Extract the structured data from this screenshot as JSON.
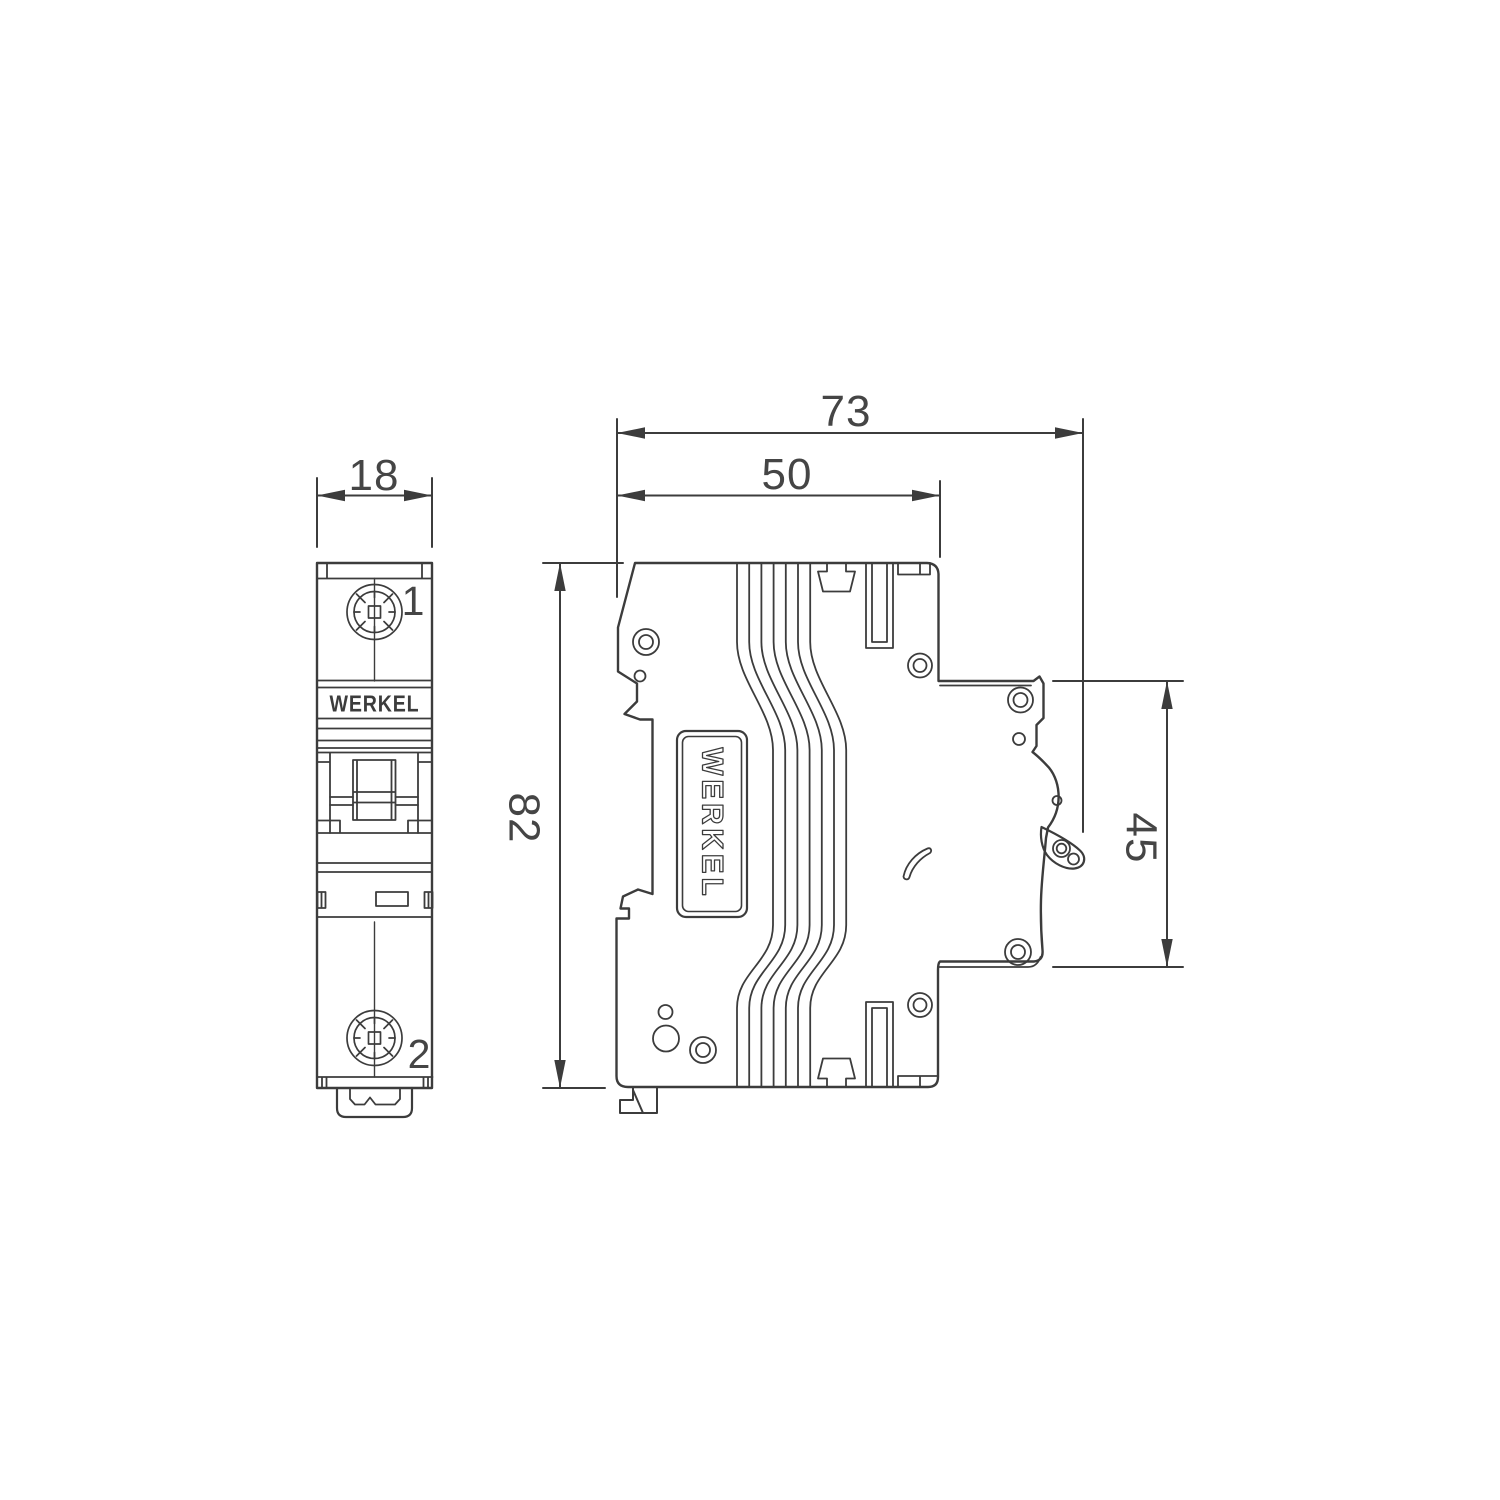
{
  "title": "WERKEL modular circuit breaker dimensional drawing",
  "colors": {
    "line": "#3c3c3c",
    "dim_text": "#454545",
    "background": "#ffffff"
  },
  "front_view": {
    "brand_label": "WERKEL",
    "terminal_top": "1",
    "terminal_bottom": "2",
    "width_dim": "18"
  },
  "side_view": {
    "brand_label": "WERKEL",
    "total_depth_dim": "73",
    "body_depth_dim": "50",
    "height_dim": "82",
    "front_height_dim": "45"
  }
}
